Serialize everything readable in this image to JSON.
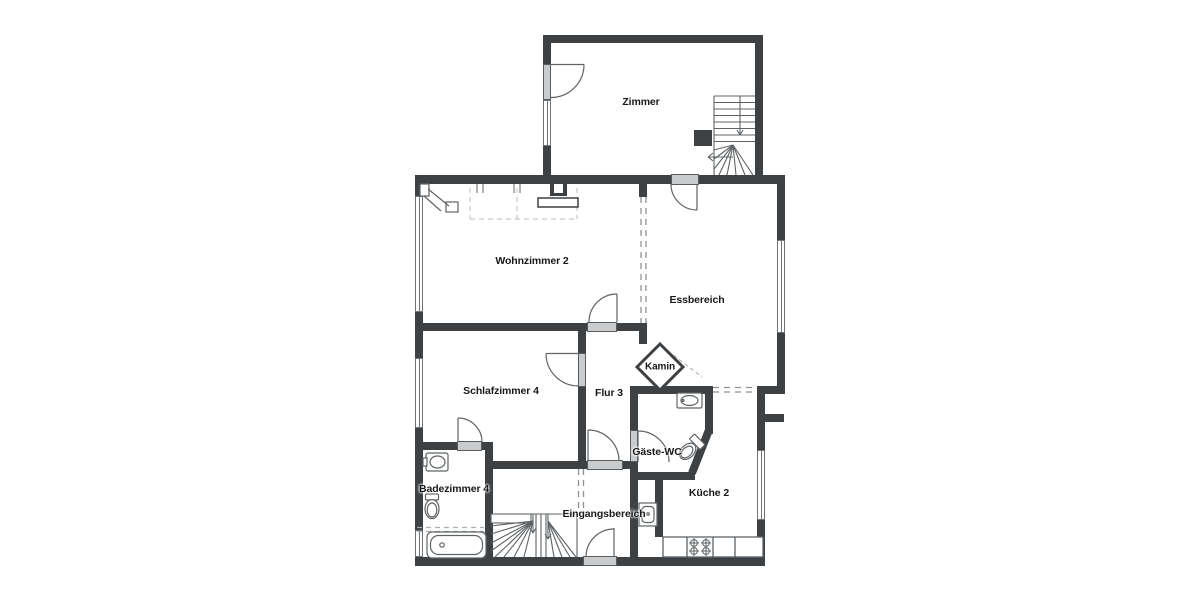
{
  "plan": {
    "rooms": {
      "zimmer": "Zimmer",
      "wohnzimmer": "Wohnzimmer 2",
      "essbereich": "Essbereich",
      "kamin": "Kamin",
      "schlafzimmer": "Schlafzimmer 4",
      "flur": "Flur 3",
      "gaeste_wc": "Gäste-WC",
      "badezimmer": "Badezimmer 4",
      "eingangsbereich": "Eingangsbereich",
      "kueche": "Küche 2"
    },
    "colors": {
      "wall": "#3e4144",
      "door_fill": "#c9cbcd",
      "fixture_line": "#5f6366",
      "dash_line": "#8e9295",
      "background": "#ffffff"
    }
  }
}
